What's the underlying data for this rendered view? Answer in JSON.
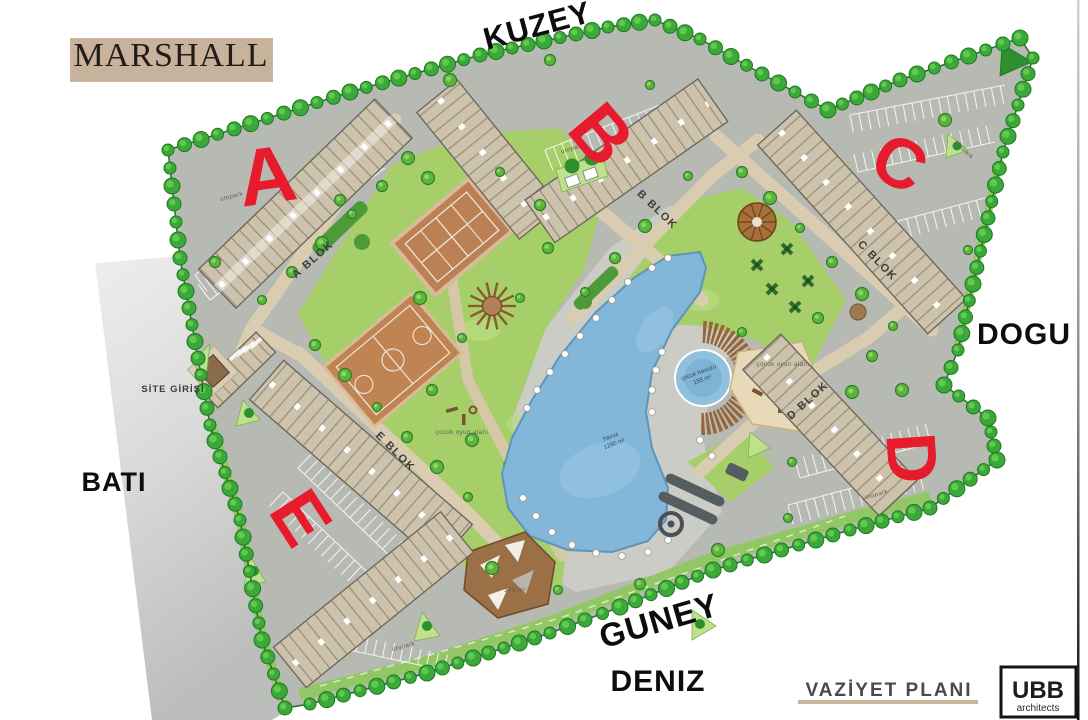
{
  "logo": {
    "text": "MARSHALL"
  },
  "compass": {
    "north": "KUZEY",
    "east": "DOGU",
    "west": "BATI",
    "south": "GUNEY",
    "sea": "DENIZ"
  },
  "site": {
    "entrance_label": "SİTE GİRİŞİ"
  },
  "blocks": {
    "a": {
      "letter": "A",
      "label": "A BLOK"
    },
    "b": {
      "letter": "B",
      "label": "B BLOK"
    },
    "c": {
      "letter": "C",
      "label": "C BLOK"
    },
    "d": {
      "letter": "D",
      "label": "D BLOK"
    },
    "e": {
      "letter": "E",
      "label": "E BLOK"
    }
  },
  "amenities": {
    "pool": {
      "name": "havuz",
      "area": "1280 m²"
    },
    "kids_pool": {
      "name": "çocuk havuzu",
      "area": "155 m²"
    },
    "playground": {
      "label": "çocuk oyun alanı"
    },
    "terrace_area": "375 m²",
    "parking_label": "otopark"
  },
  "footer": {
    "plan_title": "VAZİYET PLANI",
    "firm": {
      "name": "UBB",
      "subtitle": "architects"
    }
  },
  "colors": {
    "accent_red": "#e81b2d",
    "sea_text": "#55bd8c",
    "logo_bg": "#c7b29c",
    "tree_green": "#3aa93a",
    "pool_blue": "#83b7d9"
  }
}
